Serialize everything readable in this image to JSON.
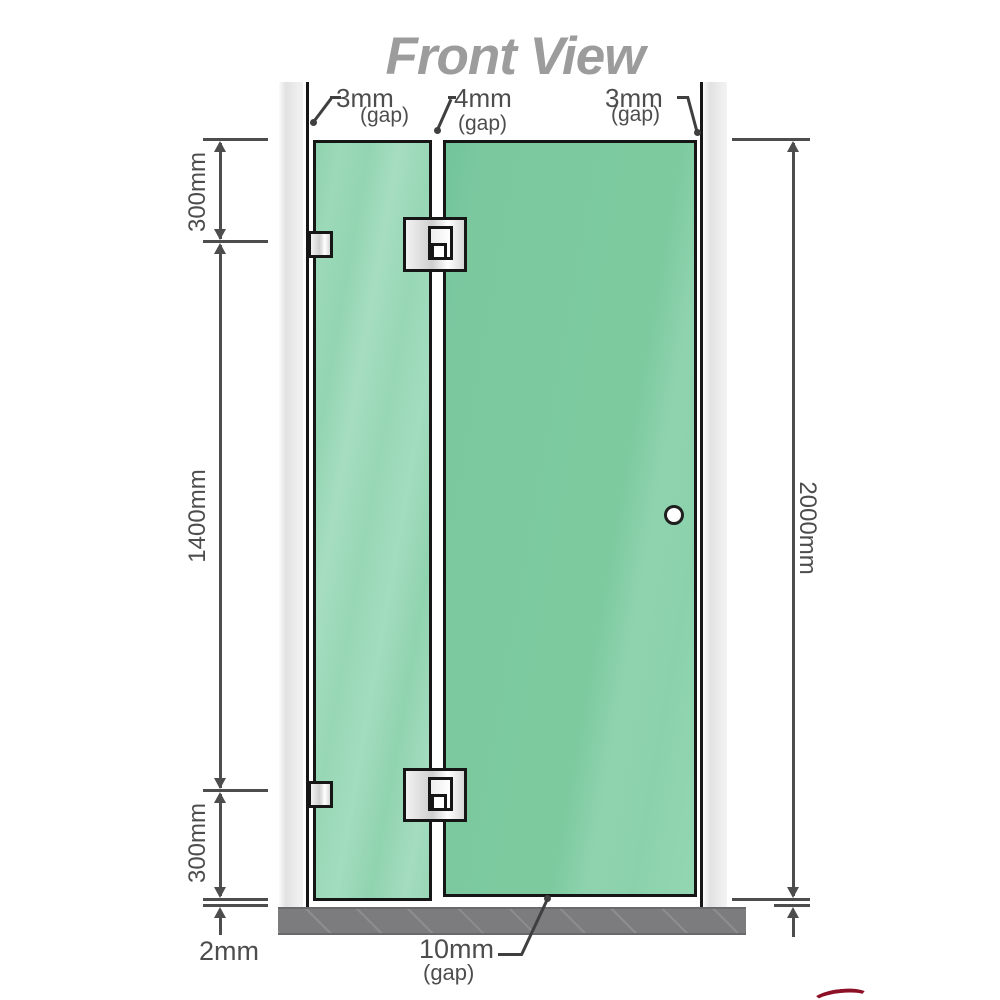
{
  "title": "Front View",
  "diagram": {
    "gap_labels": {
      "left": {
        "value": "3mm",
        "qualifier": "(gap)"
      },
      "middle": {
        "value": "4mm",
        "qualifier": "(gap)"
      },
      "right": {
        "value": "3mm",
        "qualifier": "(gap)"
      },
      "bottom": {
        "value": "10mm",
        "qualifier": "(gap)"
      }
    },
    "dimension_labels": {
      "top_left_section": "300mm",
      "middle_left_section": "1400mm",
      "bottom_left_section": "300mm",
      "overall_right": "2000mm",
      "floor_clearance": "2mm"
    },
    "colors": {
      "glass_fixed_panel": "#97d6b4",
      "glass_door_panel": "#7cc9a0",
      "wall_channel": "#e9e9e9",
      "floor_base": "#7c7c7e",
      "dimension_lines": "#4d4d4d",
      "title_text": "#9c9c9c",
      "hardware_metal": "#e5e5e5",
      "outline": "#161616",
      "logo_accent": "#8c1126"
    }
  }
}
